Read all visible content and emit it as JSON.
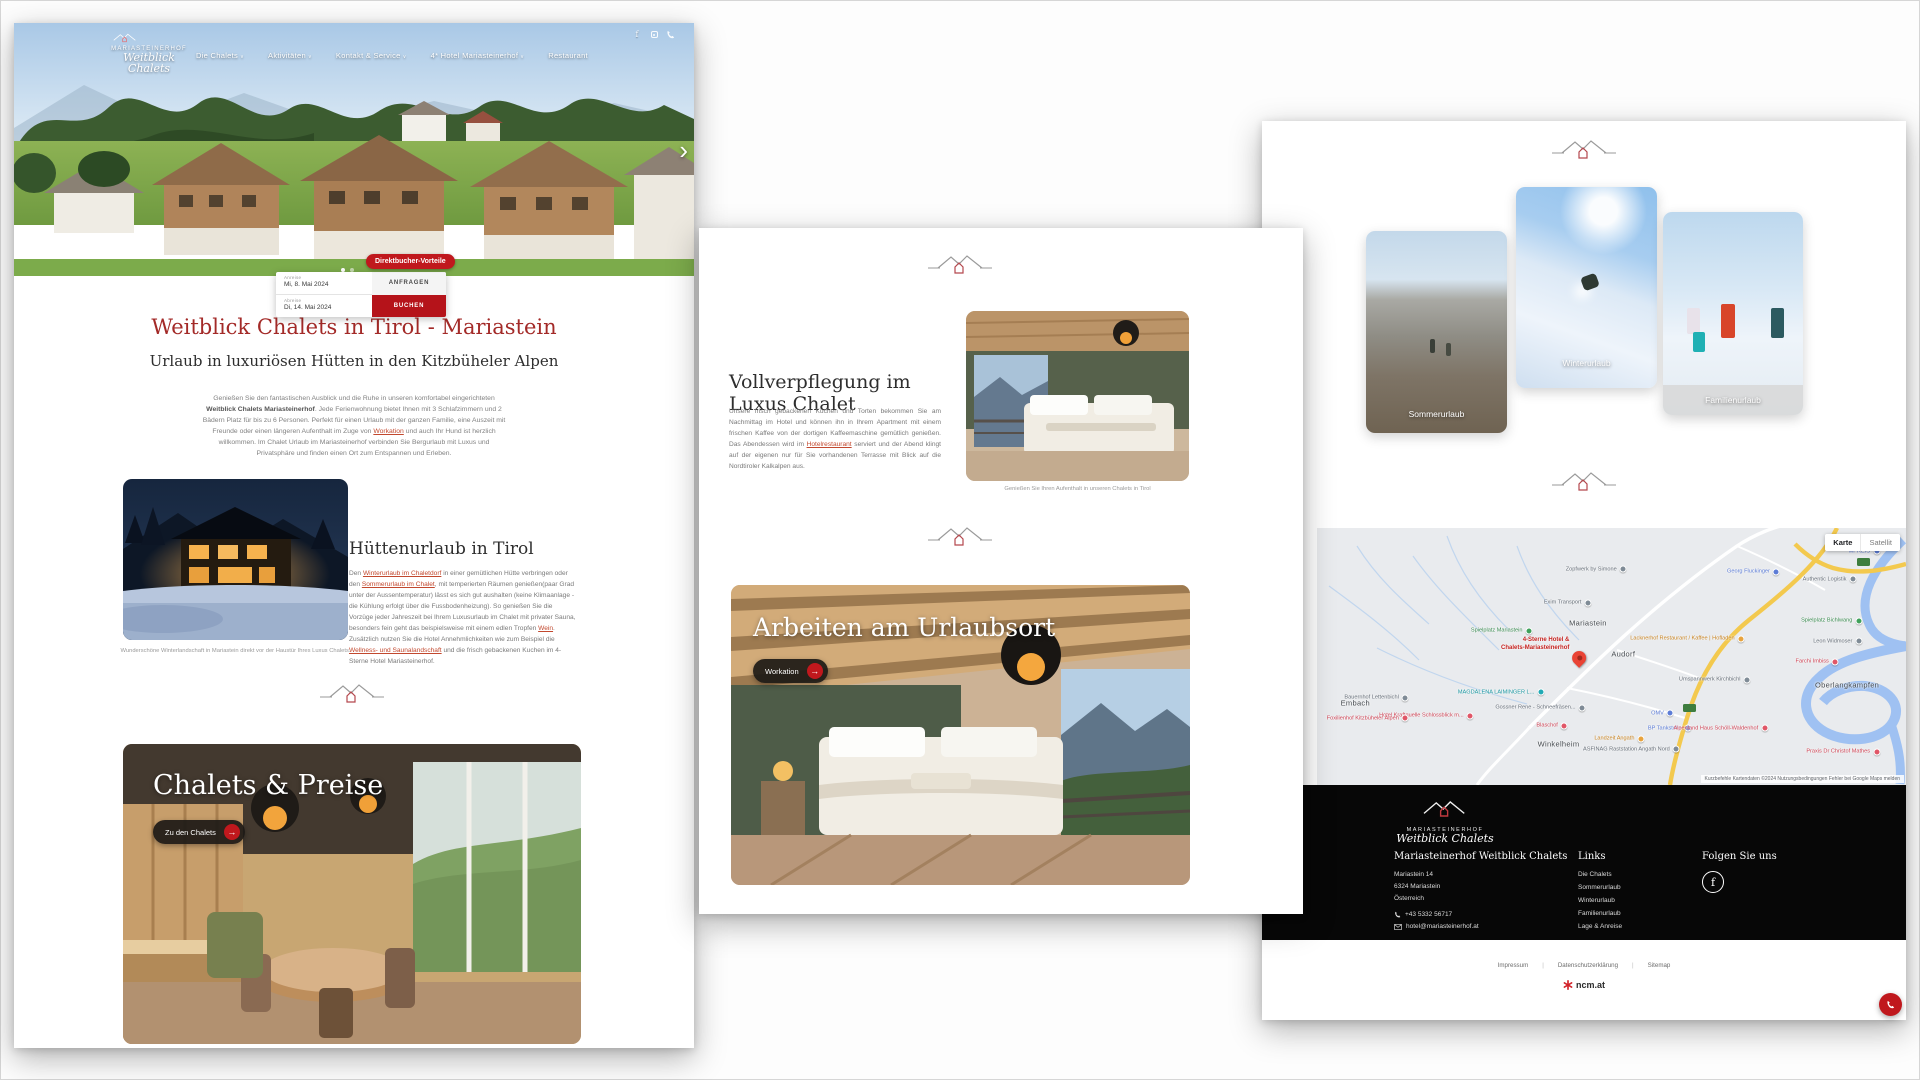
{
  "brand": {
    "name_caps": "MARIASTEINERHOF",
    "name_script": "Weitblick Chalets"
  },
  "colors": {
    "accent_red": "#c0181d",
    "heading_red": "#a32a28",
    "link_red": "#c2482e",
    "footer_bg": "#070707"
  },
  "icons": {
    "facebook": "f",
    "chevron_right": "›",
    "arrow_right": "→",
    "caret_down": "∨",
    "dot": "•"
  },
  "page1": {
    "nav": {
      "items": [
        {
          "label": "Die Chalets",
          "caret": true
        },
        {
          "label": "Aktivitäten",
          "caret": true
        },
        {
          "label": "Kontakt & Service",
          "caret": true
        },
        {
          "label": "4* Hotel Mariasteinerhof",
          "caret": true
        },
        {
          "label": "Restaurant",
          "caret": false
        }
      ]
    },
    "booking": {
      "badge": "Direktbucher-Vorteile",
      "arrival_label": "Anreise",
      "arrival_value": "Mi, 8. Mai 2024",
      "departure_label": "Abreise",
      "departure_value": "Di, 14. Mai 2024",
      "request_button": "ANFRAGEN",
      "book_button": "BUCHEN"
    },
    "title": "Weitblick Chalets in Tirol - Mariastein",
    "subtitle": "Urlaub in luxuriösen Hütten in den Kitzbüheler Alpen",
    "intro": {
      "p1": "Genießen Sie den fantastischen Ausblick und die Ruhe in unseren komfortabel eingerichteten ",
      "bold": "Weitblick Chalets Mariasteinerhof",
      "p2": ". Jede Ferienwohnung bietet Ihnen mit 3 Schlafzimmern und 2 Bädern Platz für bis zu 6 Personen. Perfekt für einen Urlaub mit der ganzen Familie, eine Auszeit mit Freunde oder einen längeren Aufenthalt im Zuge von ",
      "link": "Workation",
      "p3": " und auch Ihr Hund ist herzlich willkommen. Im Chalet Urlaub im Mariasteinerhof verbinden Sie Bergurlaub mit Luxus und Privatsphäre und finden einen Ort zum Entspannen und Erleben."
    },
    "huette": {
      "title": "Hüttenurlaub in Tirol",
      "s1": "Den ",
      "l1": "Winterurlaub im Chaletdorf",
      "s2": " in einer gemütlichen Hütte verbringen oder den ",
      "l2": "Sommerurlaub im Chalet",
      "s3": ", mit temperierten Räumen genießen(paar Grad unter der Aussentemperatur) lässt es sich gut aushalten (keine Klimaanlage - die Kühlung erfolgt über die Fussbodenheizung). So genießen Sie die Vorzüge jeder Jahreszeit bei Ihrem Luxusurlaub im Chalet mit privater Sauna, besonders fein geht das beispielsweise mit einem edlen Tropfen ",
      "l3": "Wein",
      "s4": ". Zusätzlich nutzen Sie die Hotel Annehmlichkeiten wie zum Beispiel die ",
      "l4": "Wellness- und Saunalandschaft",
      "s5": " und die frisch gebackenen Kuchen im 4-Sterne Hotel Mariasteinerhof.",
      "caption": "Wunderschöne Winterlandschaft in Mariastein direkt vor der Haustür Ihres Luxus Chalets."
    },
    "chalets": {
      "title": "Chalets & Preise",
      "button": "Zu den Chalets"
    }
  },
  "page2": {
    "food": {
      "title": "Vollverpflegung im Luxus Chalet",
      "s1": "Unsere frisch gebackenen Kuchen und Torten bekommen Sie am Nachmittag im Hotel und können ihn in Ihrem Apartment mit einem frischen Kaffee von der dortigen Kaffeemaschine gemütlich genießen. Das Abendessen wird im ",
      "l1": "Hotelrestaurant",
      "s2": " serviert und der Abend klingt auf der eigenen nur für Sie vorhandenen Terrasse mit Blick auf die Nordtiroler Kalkalpen aus.",
      "caption": "Genießen Sie Ihren Aufenthalt in unseren Chalets in Tirol"
    },
    "workation": {
      "title": "Arbeiten am Urlaubsort",
      "button": "Workation"
    }
  },
  "page3": {
    "cards": [
      {
        "key": "summer",
        "label": "Sommerurlaub"
      },
      {
        "key": "winter",
        "label": "Winterurlaub"
      },
      {
        "key": "family",
        "label": "Familienurlaub"
      }
    ],
    "map": {
      "control_map": "Karte",
      "control_sat": "Satellit",
      "pin_line1": "4-Sterne Hotel &",
      "pin_line2": "Chalets-Mariasteinerhof",
      "attribution": "Kurzbefehle   Kartendaten ©2024   Nutzungsbedingungen   Fehler bei Google Maps melden",
      "towns": [
        {
          "name": "Mariastein",
          "x": 46,
          "y": 37
        },
        {
          "name": "Audorf",
          "x": 52,
          "y": 49
        },
        {
          "name": "Embach",
          "x": 6.5,
          "y": 68
        },
        {
          "name": "Winkelheim",
          "x": 41,
          "y": 84
        },
        {
          "name": "Oberlangkampfen",
          "x": 90,
          "y": 61
        }
      ],
      "pois": [
        {
          "name": "Zopfwerk by Simone",
          "x": 52,
          "y": 16,
          "c": "gray"
        },
        {
          "name": "Georg Fluckinger",
          "x": 78,
          "y": 17,
          "c": "blue"
        },
        {
          "name": "MPREIS",
          "x": 95,
          "y": 9,
          "c": "blue"
        },
        {
          "name": "Authentic Logistik",
          "x": 91,
          "y": 20,
          "c": "gray"
        },
        {
          "name": "Exim Transport",
          "x": 46,
          "y": 29,
          "c": "gray"
        },
        {
          "name": "Spielplatz Mariastein",
          "x": 36,
          "y": 40,
          "c": "green"
        },
        {
          "name": "Spielplatz Bichlwang",
          "x": 92,
          "y": 36,
          "c": "green"
        },
        {
          "name": "Lacknerhof Restaurant / Kaffee | Hofladen",
          "x": 72,
          "y": 43,
          "c": "orange"
        },
        {
          "name": "Leon Widmoser",
          "x": 92,
          "y": 44,
          "c": "gray"
        },
        {
          "name": "Farchi Imbiss",
          "x": 88,
          "y": 52,
          "c": "red"
        },
        {
          "name": "Umspannwerk Kirchbichl",
          "x": 73,
          "y": 59,
          "c": "gray"
        },
        {
          "name": "MAGDALENA LAIMINGER L...",
          "x": 38,
          "y": 64,
          "c": "teal"
        },
        {
          "name": "Bauernhof Lettenbichl",
          "x": 15,
          "y": 66,
          "c": "gray"
        },
        {
          "name": "Gossner Rene - Schneefräsen...",
          "x": 45,
          "y": 70,
          "c": "gray"
        },
        {
          "name": "Hotel Kraftquelle Schlossblick m...",
          "x": 26,
          "y": 73,
          "c": "red"
        },
        {
          "name": "Foxilienhof Kitzbüheler Alpen",
          "x": 15,
          "y": 74,
          "c": "red"
        },
        {
          "name": "Blaschof",
          "x": 42,
          "y": 77,
          "c": "red"
        },
        {
          "name": "OMV",
          "x": 60,
          "y": 72,
          "c": "blue"
        },
        {
          "name": "BP Tankstelle",
          "x": 63,
          "y": 78,
          "c": "blue"
        },
        {
          "name": "Landzeit Angath",
          "x": 55,
          "y": 82,
          "c": "orange"
        },
        {
          "name": "ASFINAG Raststation Angath Nord",
          "x": 61,
          "y": 86,
          "c": "gray"
        },
        {
          "name": "Alpenland Haus Schöll-Waldenhof",
          "x": 76,
          "y": 78,
          "c": "red"
        },
        {
          "name": "Praxis Dr Christof Mathes",
          "x": 95,
          "y": 87,
          "c": "red"
        }
      ]
    },
    "footer": {
      "brand_heading": "Mariasteinerhof Weitblick Chalets",
      "address": [
        "Mariastein 14",
        "6324 Mariastein",
        "Österreich"
      ],
      "phone": "+43 5332 56717",
      "email": "hotel@mariasteinerhof.at",
      "links_heading": "Links",
      "links": [
        "Die Chalets",
        "Sommerurlaub",
        "Winterurlaub",
        "Familienurlaub",
        "Lage & Anreise"
      ],
      "follow_heading": "Folgen Sie uns"
    },
    "legal": {
      "links": [
        "Impressum",
        "Datenschutzerklärung",
        "Sitemap"
      ],
      "credit": "ncm.at"
    }
  }
}
